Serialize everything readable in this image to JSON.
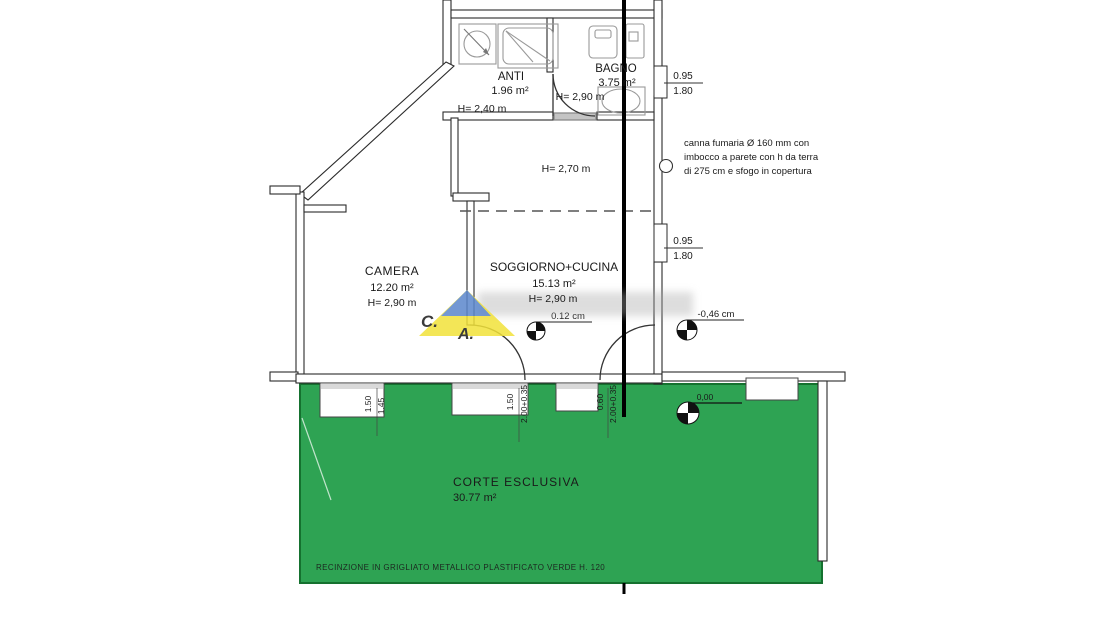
{
  "plan": {
    "rooms": {
      "anti": {
        "name": "ANTI",
        "area": "1.96 m²",
        "height": "H= 2,40 m"
      },
      "bagno": {
        "name": "BAGNO",
        "area": "3.75 m²",
        "height": "H= 2,90 m"
      },
      "camera": {
        "name": "CAMERA",
        "area": "12.20 m²",
        "height": "H= 2,90 m"
      },
      "soggiorno": {
        "name": "SOGGIORNO+CUCINA",
        "area": "15.13 m²",
        "height": "H= 2,90 m",
        "upper_height": "H= 2,70 m"
      },
      "corte": {
        "name": "CORTE ESCLUSIVA",
        "area": "30.77 m²"
      }
    },
    "annotations": {
      "flue_line1": "canna fumaria Ø 160 mm con",
      "flue_line2": "imbocco a parete con h da terra",
      "flue_line3": "di 275 cm e sfogo in copertura",
      "fence_note": "RECINZIONE IN GRIGLIATO METALLICO PLASTIFICATO VERDE H. 120"
    },
    "elevations": {
      "interior": "0.12 cm",
      "exterior": "-0,46 cm",
      "courtyard": "0,00"
    },
    "window_dims": {
      "right_top": {
        "w": "0.95",
        "h": "1.80"
      },
      "right_mid": {
        "w": "0.95",
        "h": "1.80"
      },
      "bottom_left": {
        "w": "1.50",
        "h": "1.45"
      },
      "bottom_center": {
        "w": "1.50",
        "h": "2.00+0.35"
      },
      "bottom_right": {
        "w": "0.60",
        "h": "2.00+0.35"
      }
    },
    "watermark": {
      "letter_c": "C.",
      "letter_a": "A."
    },
    "colors": {
      "courtyard_green": "#2ea353",
      "courtyard_border": "#15712f",
      "wall": "#2b2b2b",
      "logo_yellow": "#f2e23a",
      "logo_blue": "#5b87cc",
      "logo_red": "#d0483e"
    }
  }
}
